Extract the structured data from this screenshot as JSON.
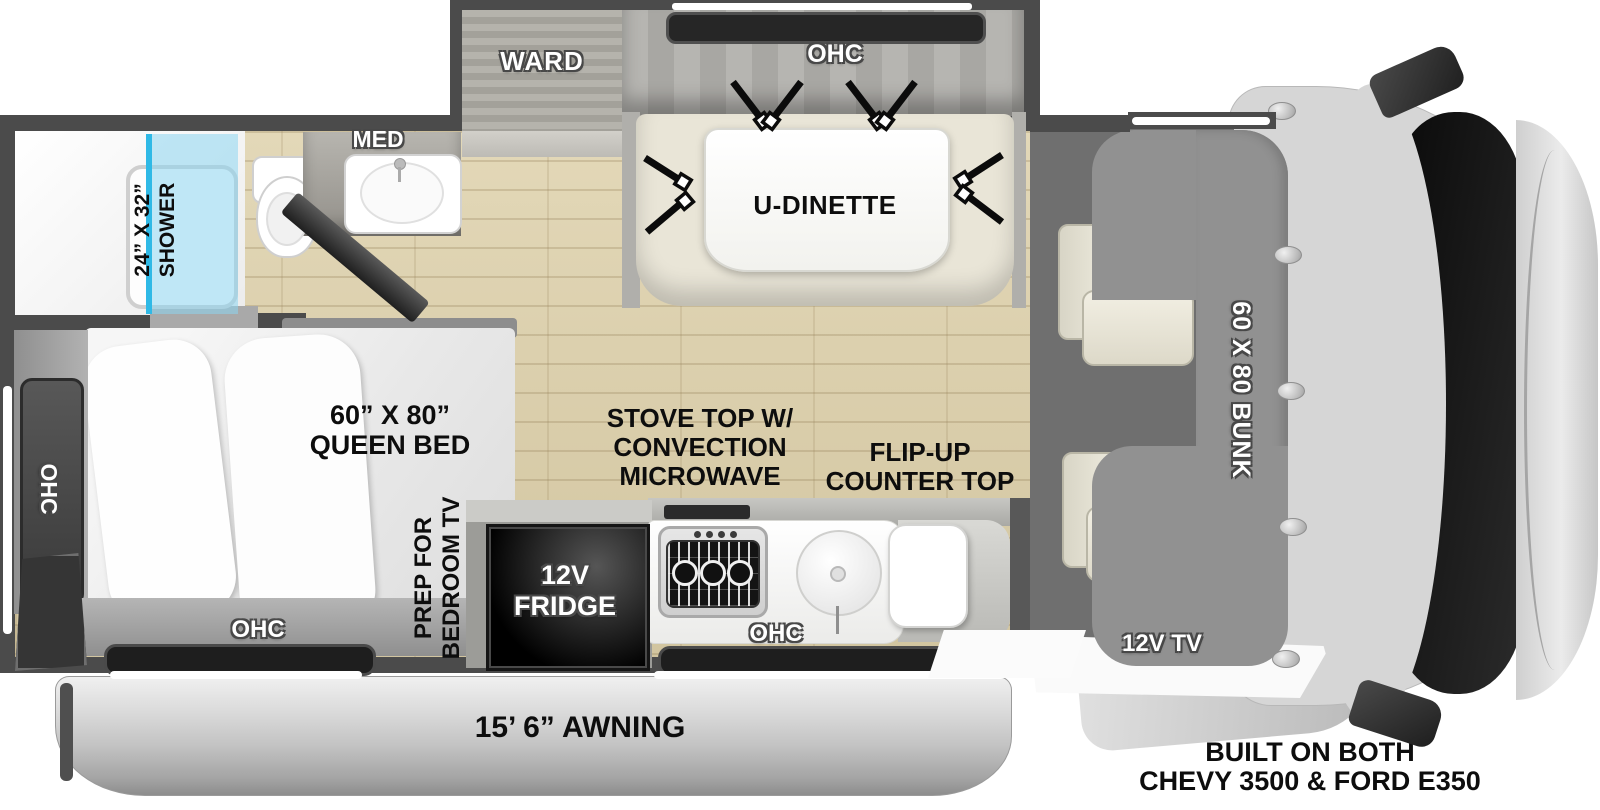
{
  "colors": {
    "wall": "#4b4b4b",
    "floor_wood": "#dbcfad",
    "shower_glass": "#8cd6f0",
    "shower_glass_edge": "#2fb9e6",
    "bunk": "#919191",
    "bench_cream": "#e9e5d7",
    "cab_gray": "#d6d6d6",
    "windshield_black": "#111111",
    "awning_gray": "#c7c7c7",
    "label_black": "#0d0d0d",
    "label_white": "#ffffff"
  },
  "icons": {
    "seatbelts": "seatbelt-icon",
    "stove": "stove-burner-icon",
    "sink": "round-sink-icon",
    "toilet": "toilet-icon",
    "rivets": "rivet-icon",
    "mirrors": "side-mirror-icon"
  },
  "labels": {
    "shower": {
      "line1": "24” X 32”",
      "line2": "SHOWER"
    },
    "med": "MED",
    "ward": "WARD",
    "ohc_dinette": "OHC",
    "dinette": "U-DINETTE",
    "queen_bed": {
      "line1": "60” X 80”",
      "line2": "QUEEN BED"
    },
    "ohc_bedroom_side": "OHC",
    "ohc_bedroom_foot": "OHC",
    "tv_prep": {
      "line1": "PREP FOR",
      "line2": "BEDROOM TV"
    },
    "stove": {
      "line1": "STOVE TOP W/",
      "line2": "CONVECTION",
      "line3": "MICROWAVE"
    },
    "flip_counter": {
      "line1": "FLIP-UP",
      "line2": "COUNTER TOP"
    },
    "fridge": {
      "line1": "12V",
      "line2": "FRIDGE"
    },
    "ohc_kitchen": "OHC",
    "bunk": "60 X 80 BUNK",
    "cab_tv": "12V TV",
    "awning": "15’ 6” AWNING",
    "chassis": {
      "line1": "BUILT ON BOTH",
      "line2": "CHEVY 3500 & FORD E350"
    }
  }
}
